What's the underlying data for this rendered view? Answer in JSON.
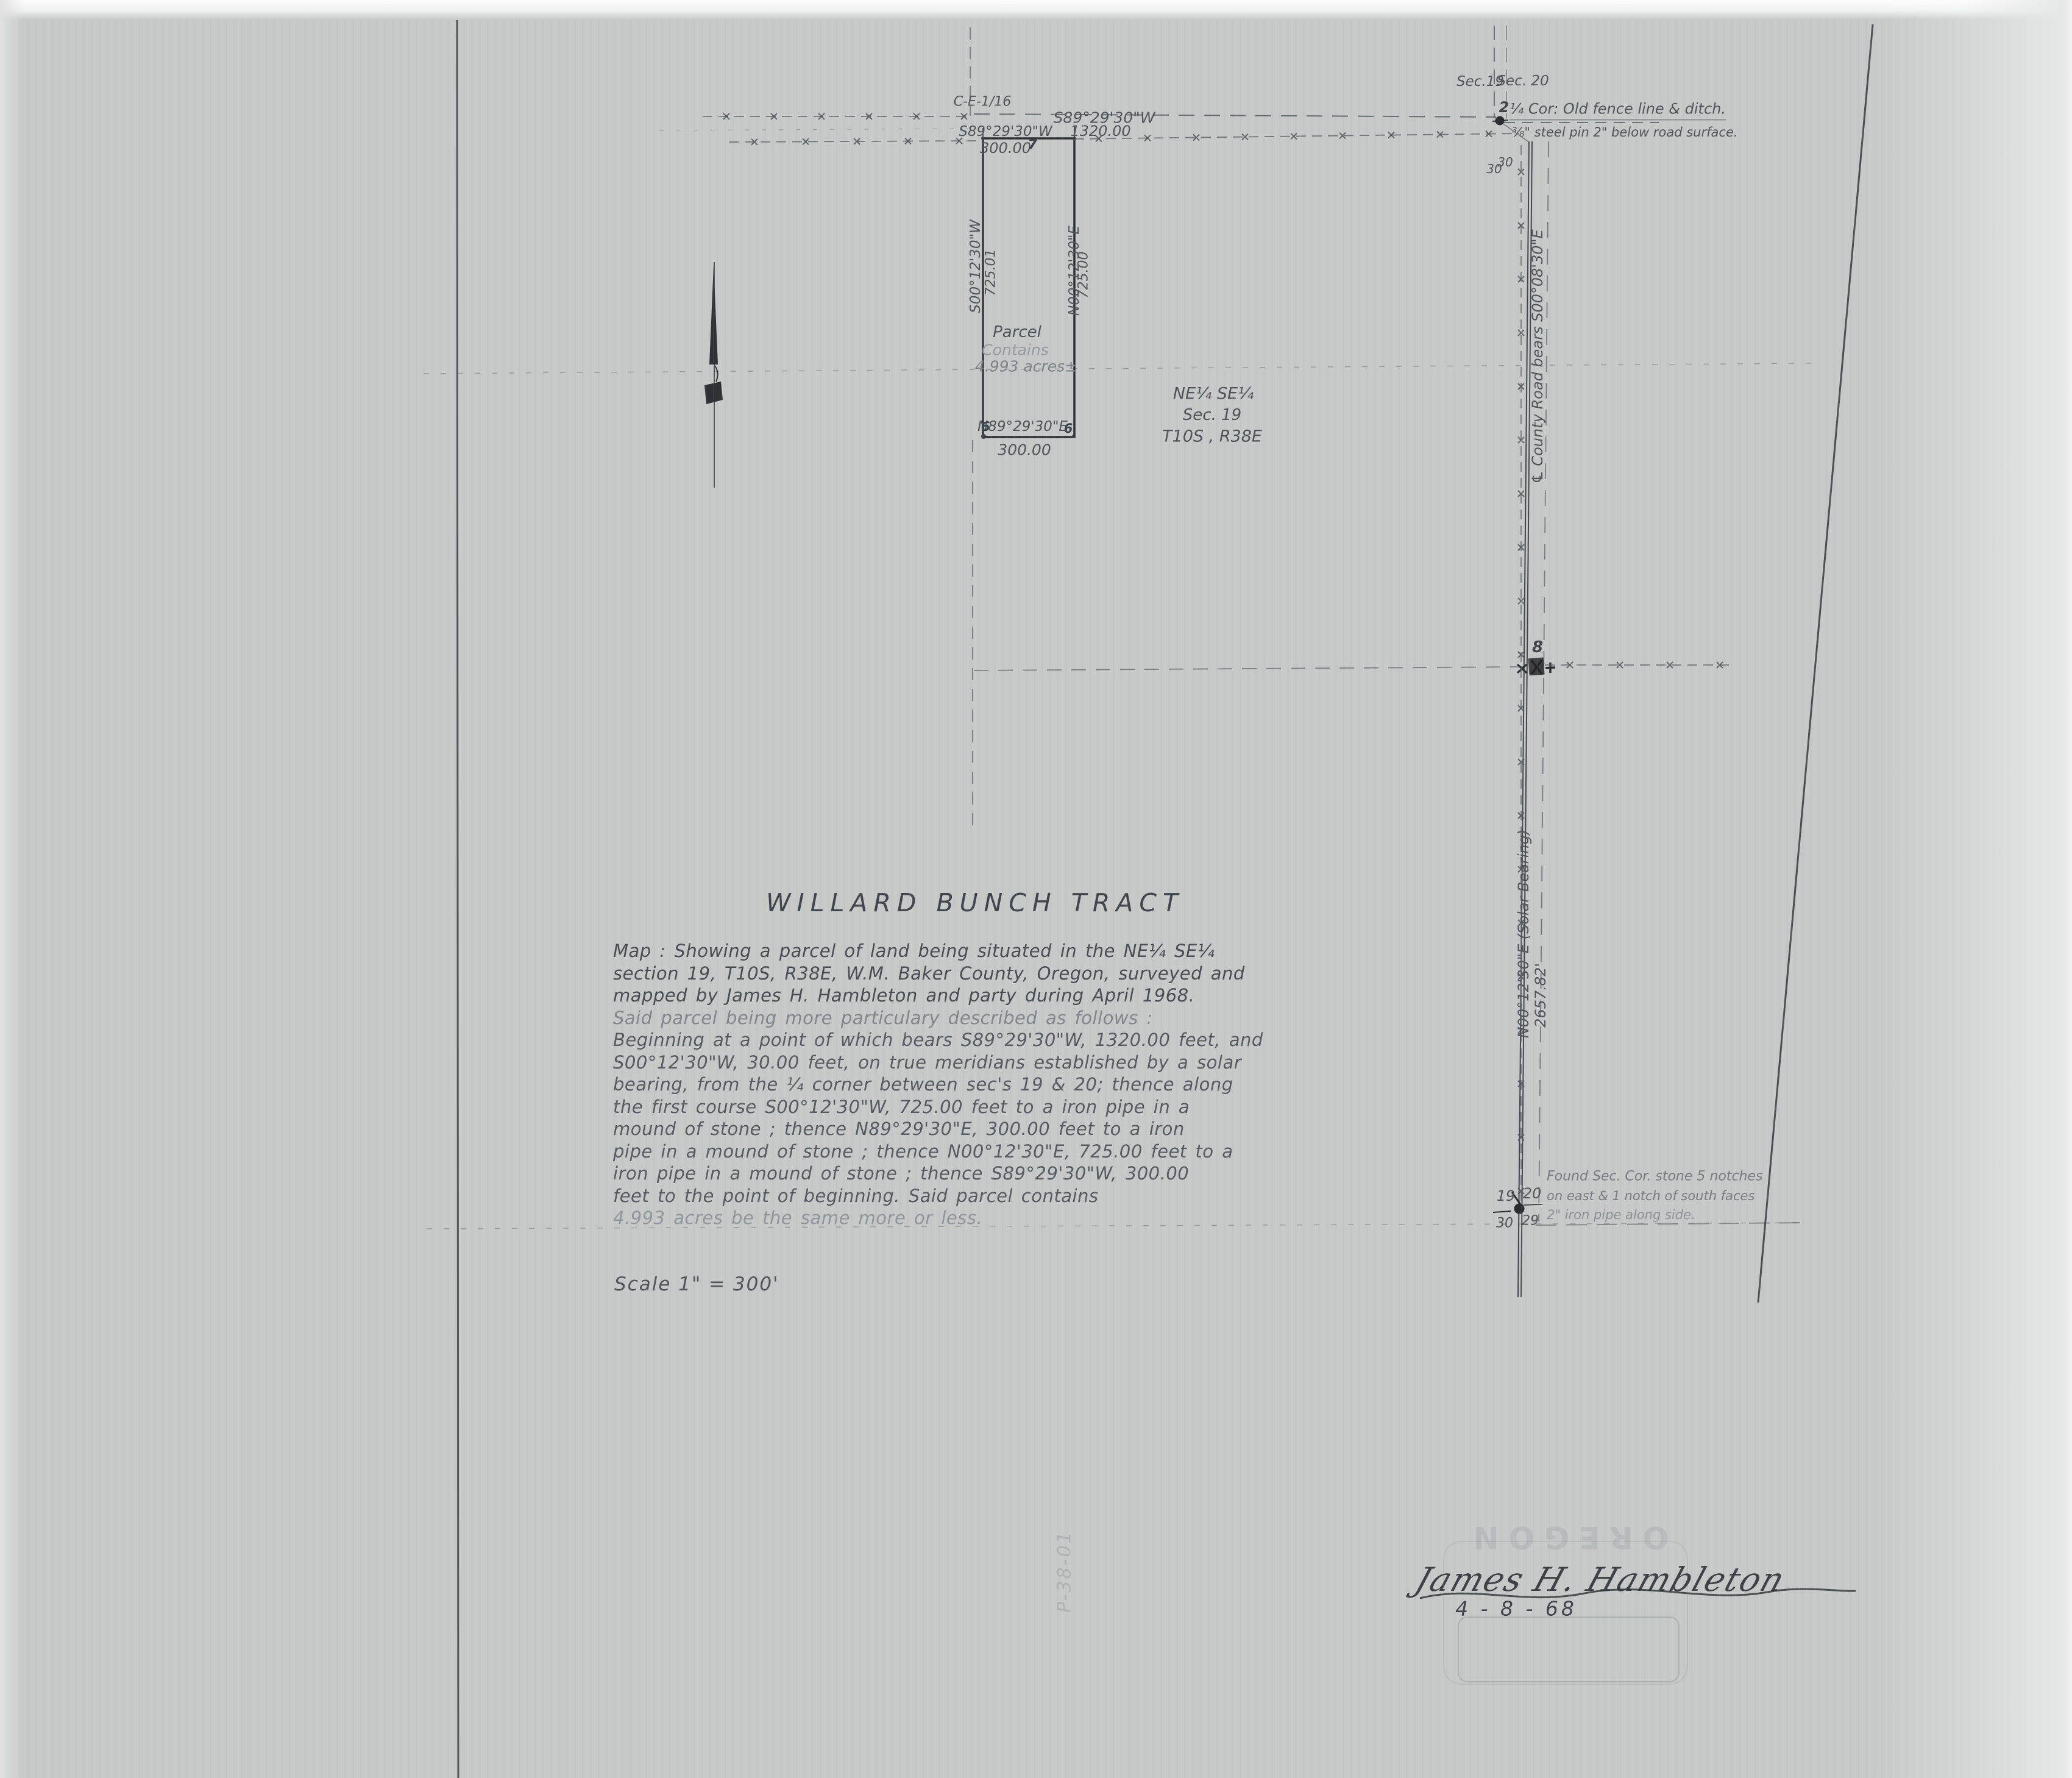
{
  "page": {
    "title": "WILLARD BUNCH TRACT",
    "scale_label": "Scale  1\" = 300'",
    "file_code": "P-38-01",
    "description": {
      "lines": [
        "Map :  Showing a parcel of land being situated in the NE¼ SE¼",
        "section 19,  T10S, R38E, W.M. Baker County, Oregon, surveyed and",
        "mapped by  James H. Hambleton  and party during April 1968.",
        "Said parcel being more particulary described as follows :",
        "Beginning at a point of which bears S89°29'30\"W, 1320.00 feet, and",
        "S00°12'30\"W, 30.00 feet, on true meridians established by a solar",
        "bearing, from the ¼ corner between sec's 19 & 20;  thence along",
        "the first course S00°12'30\"W, 725.00 feet to a iron pipe in a",
        "mound of stone ;  thence N89°29'30\"E, 300.00 feet to a iron",
        "pipe in a mound of stone ;  thence N00°12'30\"E, 725.00 feet to a",
        "iron pipe in a mound of stone ;  thence S89°29'30\"W, 300.00",
        "feet to the point of beginning.  Said parcel contains",
        "4.993 acres be the same more or less."
      ]
    },
    "signature": {
      "name": "James H. Hambleton",
      "date": "4 - 8 - 68"
    },
    "stamp_ghost_text": "OREGON"
  },
  "map": {
    "labels": {
      "ce_sixteenth_corner": "C-E-1/16",
      "quarter_line_bearing": "S89°29'30\"W",
      "quarter_line_distance": "1320.00",
      "parcel_north_bearing": "S89°29'30\"W",
      "parcel_north_distance": "300.00",
      "parcel_west_bearing": "S00°12'30\"W",
      "parcel_west_distance": "725.01",
      "parcel_east_bearing": "N00°12'30\"E",
      "parcel_east_distance": "725.00",
      "parcel_south_bearing": "N89°29'30\"E",
      "parcel_south_distance": "300.00",
      "parcel_name": "Parcel",
      "parcel_contains": "Contains",
      "parcel_area": "4.993 acres±",
      "aliquot_line1": "NE¼   SE¼",
      "aliquot_line2": "Sec.   19",
      "aliquot_line3": "T10S ,   R38E",
      "sec19": "Sec.19",
      "sec20": "Sec. 20",
      "offset_north_w": "30",
      "offset_north_e": "30",
      "quarter_corner_note1": "¼ Cor: Old fence line & ditch.",
      "quarter_corner_note2": "⅜\" steel pin 2\" below road surface.",
      "road_centerline": "℄ County Road bears S00°08'30\"E",
      "road_solar": "N00°12'30\"E   (Solar Bearing)",
      "road_solar_distance": "2657.82'",
      "sec_corner_nw": "19",
      "sec_corner_ne": "20",
      "sec_corner_sw": "30",
      "sec_corner_se": "29",
      "found_note1": "Found Sec. Cor. stone 5 notches",
      "found_note2": "on east & 1 notch of south faces",
      "found_note3": "2\" iron pipe along side.",
      "pt2": "2",
      "pt6a": "6",
      "pt6b": "6",
      "pt7": "7",
      "pt8": "8"
    }
  }
}
